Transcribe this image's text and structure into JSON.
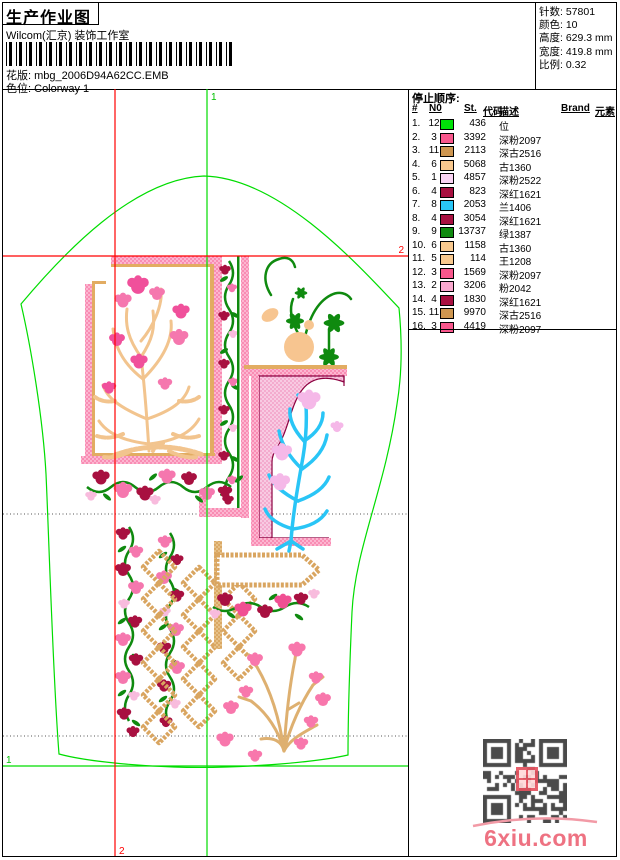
{
  "header": {
    "title": "生产作业图",
    "subtitle": "Wilcom(汇京) 装饰工作室",
    "pattern_label": "花版:",
    "pattern_value": "mbg_2006D94A62CC.EMB",
    "colorway_label": "色位:",
    "colorway_value": "Colorway 1",
    "barcode_icon": "barcode-icon"
  },
  "stats": {
    "stitches_label": "针数:",
    "stitches_value": "57801",
    "colors_label": "颜色:",
    "colors_value": "10",
    "height_label": "高度:",
    "height_value": "629.3 mm",
    "width_label": "宽度:",
    "width_value": "419.8 mm",
    "scale_label": "比例:",
    "scale_value": "0.32"
  },
  "stop_sequence": {
    "title": "停止顺序:",
    "columns": [
      "#",
      "N0",
      "St.",
      "代码",
      "描述",
      "Brand",
      "元素"
    ],
    "rows": [
      {
        "idx": "1.",
        "n0": "12",
        "chip": "#00e308",
        "st": "436",
        "desc": "位"
      },
      {
        "idx": "2.",
        "n0": "3",
        "chip": "#f8578c",
        "st": "3392",
        "desc": "深粉2097"
      },
      {
        "idx": "3.",
        "n0": "11",
        "chip": "#ce9650",
        "st": "2113",
        "desc": "深古2516"
      },
      {
        "idx": "4.",
        "n0": "6",
        "chip": "#f8c88e",
        "st": "5068",
        "desc": "古1360"
      },
      {
        "idx": "5.",
        "n0": "1",
        "chip": "#fad4f4",
        "st": "4857",
        "desc": "深粉2522"
      },
      {
        "idx": "6.",
        "n0": "4",
        "chip": "#a81040",
        "st": "823",
        "desc": "深红1621"
      },
      {
        "idx": "7.",
        "n0": "8",
        "chip": "#29c5f6",
        "st": "2053",
        "desc": "兰1406"
      },
      {
        "idx": "8.",
        "n0": "4",
        "chip": "#a81040",
        "st": "3054",
        "desc": "深红1621"
      },
      {
        "idx": "9.",
        "n0": "9",
        "chip": "#0f8a0f",
        "st": "13737",
        "desc": "绿1387"
      },
      {
        "idx": "10.",
        "n0": "6",
        "chip": "#f8c88e",
        "st": "1158",
        "desc": "古1360"
      },
      {
        "idx": "11.",
        "n0": "5",
        "chip": "#f8c88e",
        "st": "114",
        "desc": "王1208"
      },
      {
        "idx": "12.",
        "n0": "3",
        "chip": "#f8578c",
        "st": "1569",
        "desc": "深粉2097"
      },
      {
        "idx": "13.",
        "n0": "2",
        "chip": "#f9a8ce",
        "st": "3206",
        "desc": "粉2042"
      },
      {
        "idx": "14.",
        "n0": "4",
        "chip": "#a81040",
        "st": "1830",
        "desc": "深红1621"
      },
      {
        "idx": "15.",
        "n0": "11",
        "chip": "#ce9650",
        "st": "9970",
        "desc": "深古2516"
      },
      {
        "idx": "16.",
        "n0": "3",
        "chip": "#f8578c",
        "st": "4419",
        "desc": "深粉2097"
      }
    ]
  },
  "canvas": {
    "marker_1": "1",
    "marker_2": "2",
    "outline_color": "#00dd00",
    "marker_color": "#ff0000"
  },
  "watermark": {
    "text": "6xiu.com",
    "color": "#ee7282",
    "qr_icon": "qr-code-icon"
  }
}
